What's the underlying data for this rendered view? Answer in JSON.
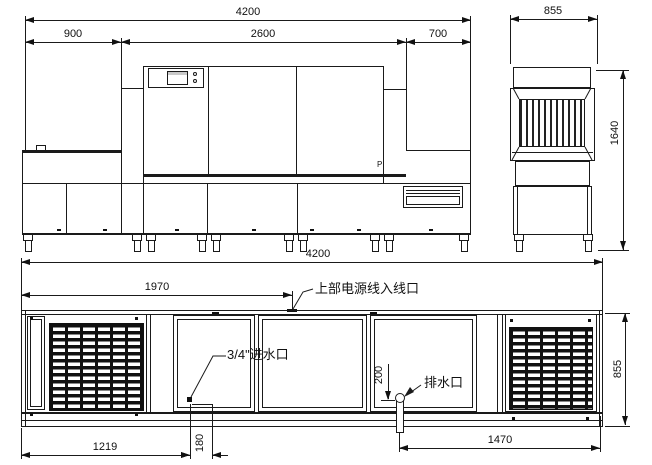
{
  "drawing": {
    "elevation": {
      "dim_total": "4200",
      "dim_left": "900",
      "dim_mid": "2600",
      "dim_right": "700",
      "p_mark": "P"
    },
    "side_view": {
      "dim_width": "855",
      "dim_height": "1640"
    },
    "plan": {
      "dim_total": "4200",
      "dim_power": "1970",
      "dim_inlet_x": "1219",
      "dim_inlet_off": "180",
      "dim_drain_off": "200",
      "dim_drain_x": "1470",
      "dim_depth": "855",
      "label_power": "上部电源线入线口",
      "label_inlet": "3/4\"进水口",
      "label_drain": "排水口"
    },
    "line_color": "#1a1a1a"
  }
}
